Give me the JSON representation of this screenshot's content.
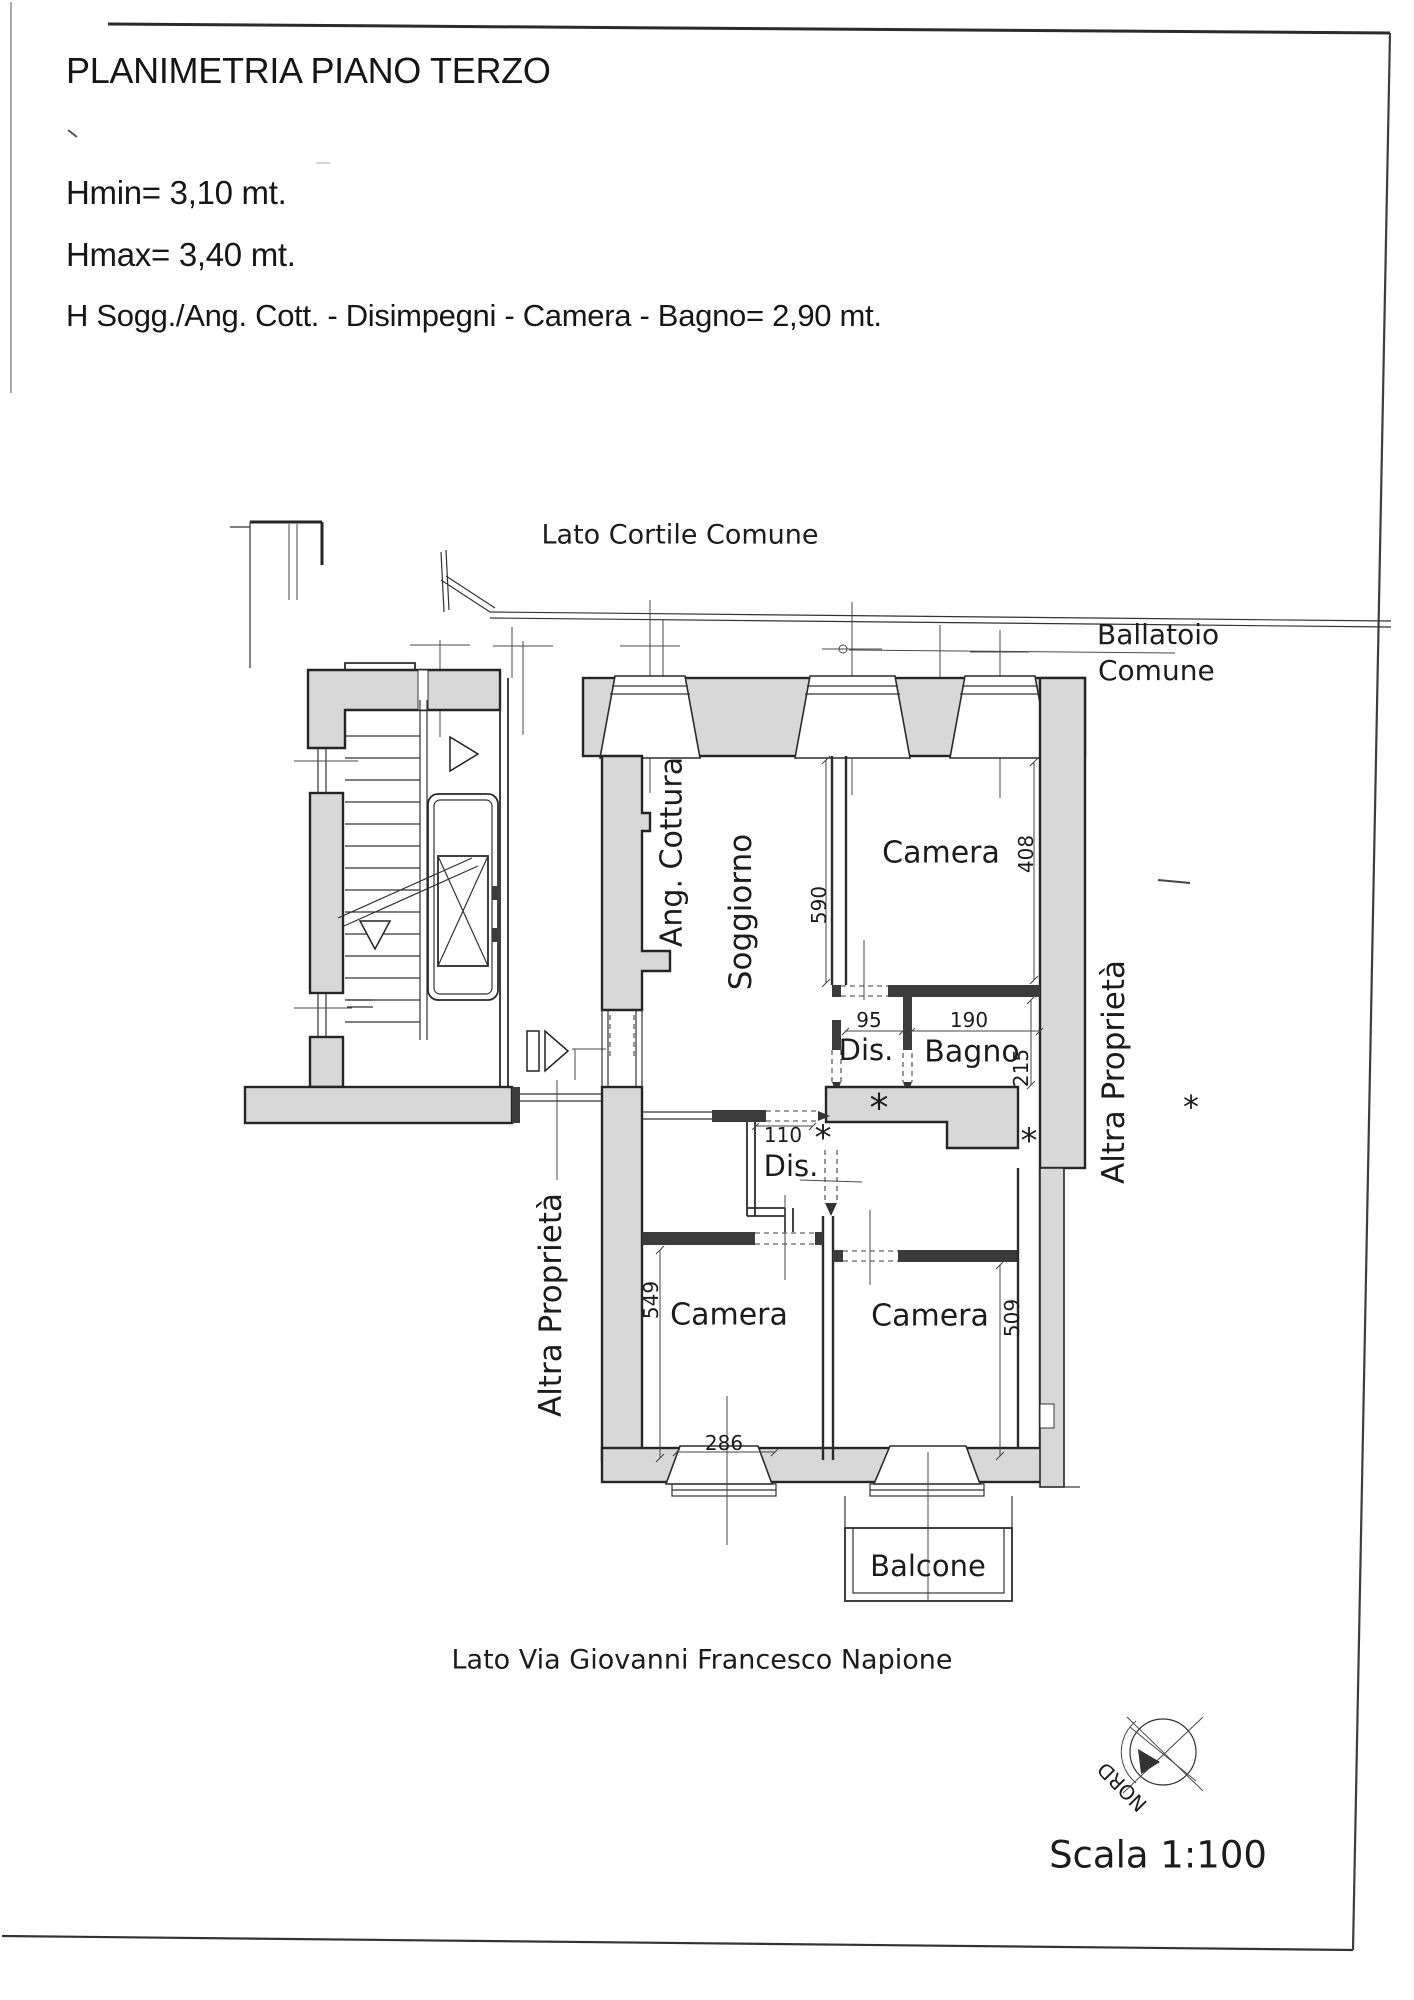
{
  "header": {
    "title": "PLANIMETRIA PIANO TERZO",
    "hmin": "Hmin= 3,10 mt.",
    "hmax": "Hmax= 3,40 mt.",
    "heights": "H Sogg./Ang. Cott. - Disimpegni - Camera - Bagno= 2,90 mt."
  },
  "plan": {
    "boundaries": {
      "lato_cortile": "Lato Cortile Comune",
      "ballatoio_line1": "Ballatoio",
      "ballatoio_line2": "Comune",
      "lato_via": "Lato Via Giovanni Francesco Napione",
      "altra_left": "Altra Proprietà",
      "altra_right": "Altra Proprietà"
    },
    "rooms": {
      "ang_cottura": "Ang. Cottura",
      "soggiorno": "Soggiorno",
      "camera_top": "Camera",
      "dis_upper": "Dis.",
      "bagno": "Bagno",
      "dis_lower": "Dis.",
      "camera_bl": "Camera",
      "camera_br": "Camera",
      "balcone": "Balcone"
    },
    "dims": {
      "d590": "590",
      "d408": "408",
      "d95": "95",
      "d190": "190",
      "d215": "215",
      "d110": "110",
      "d549": "549",
      "d509": "509",
      "d286": "286"
    },
    "markers": {
      "asterisk": "*"
    }
  },
  "footer": {
    "nord": "NORD",
    "scala": "Scala 1:100"
  },
  "colors": {
    "ink": "#1c1c1c",
    "wall_fill": "#d8d8d8",
    "line": "#2a2a2a",
    "paper": "#ffffff"
  }
}
